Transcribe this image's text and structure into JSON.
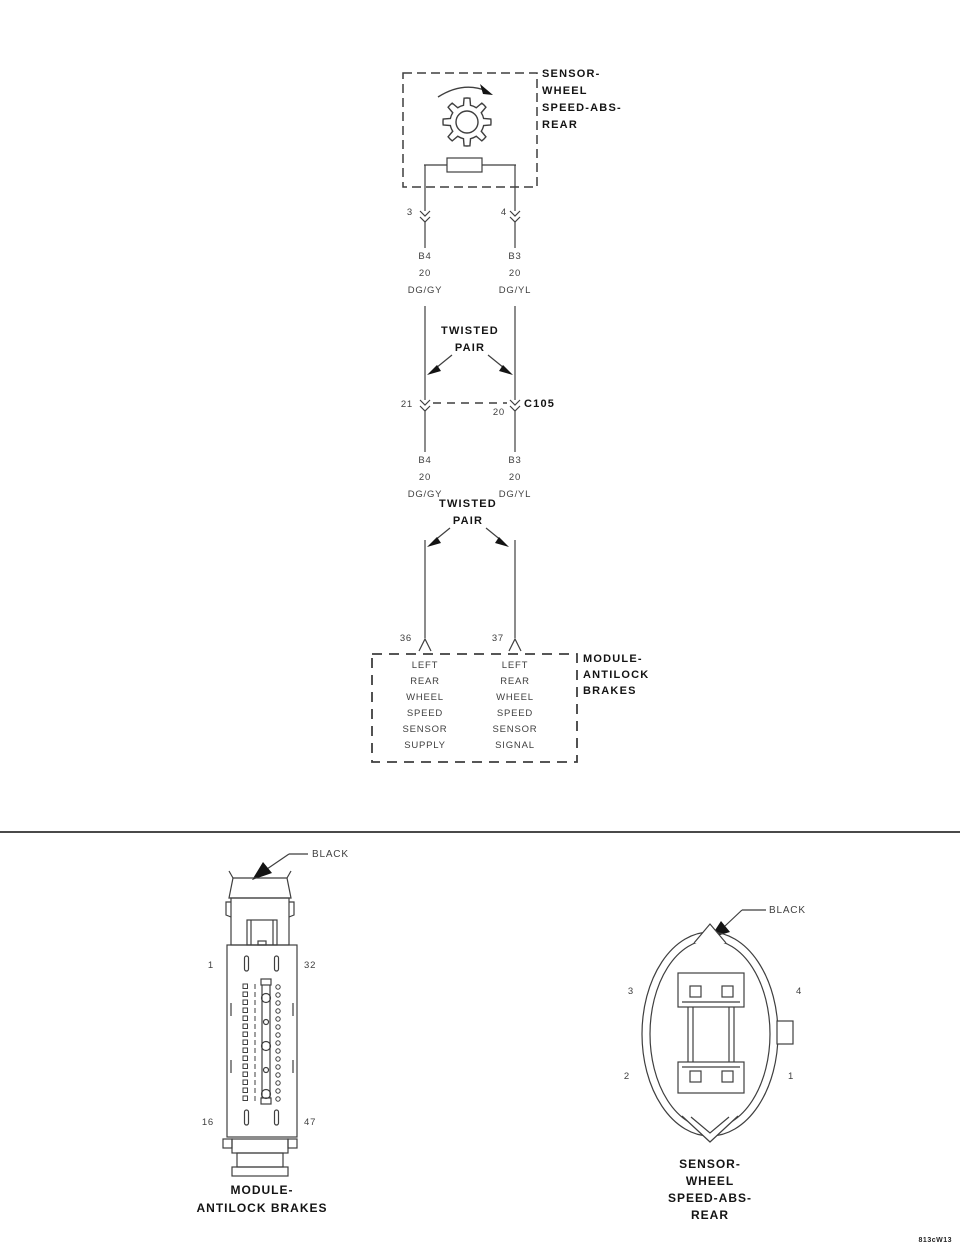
{
  "colors": {
    "ink": "#3f3f3f",
    "bold_ink": "#141414",
    "background": "#ffffff"
  },
  "schematic": {
    "sensor": {
      "label": "SENSOR-\nWHEEL\nSPEED-ABS-\nREAR",
      "pin_left": "3",
      "pin_right": "4"
    },
    "wires": {
      "seg1_left": "B4\n20\nDG/GY",
      "seg1_right": "B3\n20\nDG/YL",
      "seg2_left": "B4\n20\nDG/GY",
      "seg2_right": "B3\n20\nDG/YL"
    },
    "twisted_pair_upper": "TWISTED\nPAIR",
    "twisted_pair_lower": "TWISTED\nPAIR",
    "inline_connector": {
      "name": "C105",
      "pin_left": "21",
      "pin_right": "20"
    },
    "module": {
      "label": "MODULE-\nANTILOCK\nBRAKES",
      "pin_left": "36",
      "pin_right": "37",
      "circuit_left": "LEFT\nREAR\nWHEEL\nSPEED\nSENSOR\nSUPPLY",
      "circuit_right": "LEFT\nREAR\nWHEEL\nSPEED\nSENSOR\nSIGNAL"
    }
  },
  "connector_views": {
    "module": {
      "color_label": "BLACK",
      "pin_top_left": "1",
      "pin_top_right": "32",
      "pin_bottom_left": "16",
      "pin_bottom_right": "47",
      "caption": "MODULE-\nANTILOCK BRAKES"
    },
    "sensor": {
      "color_label": "BLACK",
      "pin_top_left": "3",
      "pin_top_right": "4",
      "pin_bottom_left": "2",
      "pin_bottom_right": "1",
      "caption": "SENSOR-\nWHEEL\nSPEED-ABS-\nREAR"
    }
  },
  "footer": {
    "figure_code": "813cW13"
  }
}
